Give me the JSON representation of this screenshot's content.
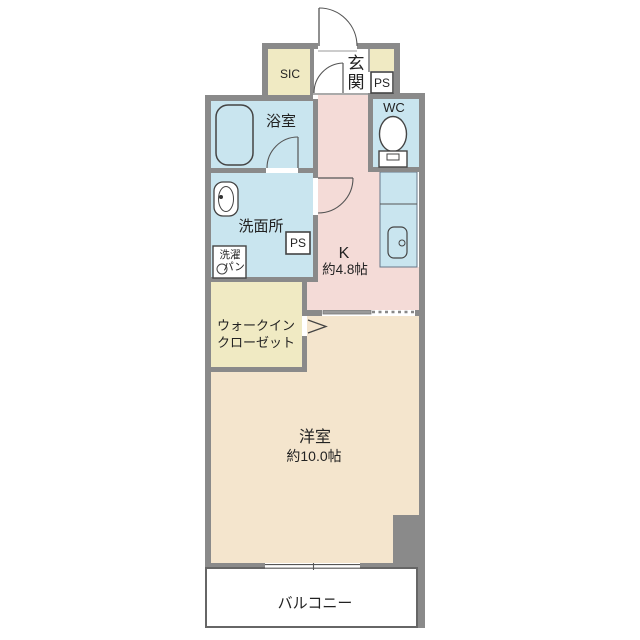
{
  "palette": {
    "wall_gray": "#8a8a8a",
    "water_blue": "#c9e5ef",
    "kitchen_pink": "#f4dbd7",
    "room_beige": "#f4e5cd",
    "closet_cream": "#f0eac3",
    "fixture_line": "#444444",
    "background": "#ffffff"
  },
  "rooms": {
    "sic": {
      "label": "SIC"
    },
    "entrance": {
      "char1": "玄",
      "char2": "関"
    },
    "ps_top": {
      "label": "PS"
    },
    "wc": {
      "label": "WC"
    },
    "bath": {
      "label": "浴室"
    },
    "washroom": {
      "label": "洗面所"
    },
    "laundry_pan": {
      "line1": "洗濯",
      "line2": "パン"
    },
    "ps_mid": {
      "label": "PS"
    },
    "kitchen": {
      "label": "K",
      "size": "約4.8帖"
    },
    "walk_in_closet": {
      "line1": "ウォークイン",
      "line2": "クローゼット"
    },
    "bedroom": {
      "label": "洋室",
      "size": "約10.0帖"
    },
    "balcony": {
      "label": "バルコニー"
    }
  }
}
